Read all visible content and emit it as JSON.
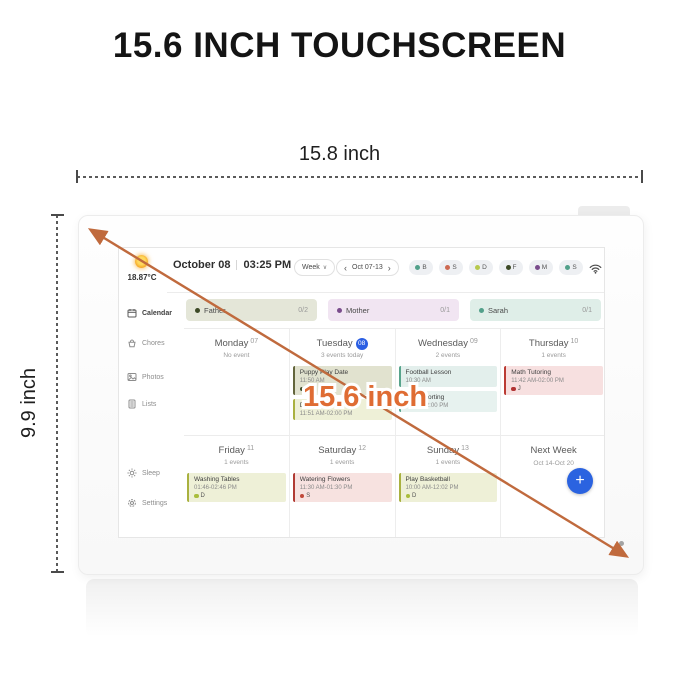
{
  "annotation": {
    "title": "15.6 INCH TOUCHSCREEN",
    "width_label": "15.8 inch",
    "height_label": "9.9 inch",
    "diagonal_label": "15.6 inch",
    "arrow_color": "#c06a3d",
    "diagonal_label_color": "#df6c33"
  },
  "screen": {
    "weather": {
      "temperature": "18.87°C"
    },
    "header": {
      "date": "October 08",
      "time": "03:25 PM",
      "view": "Week",
      "range": "Oct 07-13",
      "avatars": [
        {
          "initial": "B",
          "color": "#52a08a"
        },
        {
          "initial": "S",
          "color": "#cd6a52"
        },
        {
          "initial": "D",
          "color": "#b7c94e"
        },
        {
          "initial": "F",
          "color": "#3d4a26"
        },
        {
          "initial": "M",
          "color": "#7a4c8c"
        },
        {
          "initial": "S",
          "color": "#52a08a"
        }
      ]
    },
    "sidebar": [
      {
        "label": "Calendar",
        "icon": "calendar-icon"
      },
      {
        "label": "Chores",
        "icon": "chores-icon"
      },
      {
        "label": "Photos",
        "icon": "photos-icon"
      },
      {
        "label": "Lists",
        "icon": "lists-icon"
      },
      {
        "label": "Sleep",
        "icon": "sleep-icon"
      },
      {
        "label": "Settings",
        "icon": "settings-icon"
      }
    ],
    "members": [
      {
        "name": "Father",
        "count": "0/2",
        "dot": "#3d4a26",
        "bg": "#e4e6d8"
      },
      {
        "name": "Mother",
        "count": "0/1",
        "dot": "#7a4c8c",
        "bg": "#f1e5f2"
      },
      {
        "name": "Sarah",
        "count": "0/1",
        "dot": "#52a08a",
        "bg": "#dfeee8"
      }
    ],
    "week": {
      "today_badge_color": "#2b5fe3",
      "add_button_color": "#2b63e0",
      "days": [
        {
          "name": "Monday",
          "num": "07",
          "sub": "No event",
          "events": []
        },
        {
          "name": "Tuesday",
          "num": "08",
          "sub": "3 events today",
          "events": [
            {
              "title": "Puppy Play Date",
              "time": "11:50 AM",
              "who": "F",
              "who_color": "#3d4a26",
              "bg": "#e1e2cf",
              "border": "#63653c"
            },
            {
              "title": "Drying Laundry",
              "time": "11:51 AM-02:00 PM",
              "bg": "#eef0d7",
              "border": "#a9b13f"
            }
          ]
        },
        {
          "name": "Wednesday",
          "num": "09",
          "sub": "2 events",
          "events": [
            {
              "title": "Football Lesson",
              "time": "10:30 AM",
              "bg": "#e3efec",
              "border": "#58a48c"
            },
            {
              "title": "Trash Sorting",
              "time": "01:00-02:00 PM",
              "bg": "#e7f2ef",
              "border": "#58a48c"
            }
          ]
        },
        {
          "name": "Thursday",
          "num": "10",
          "sub": "1 events",
          "events": [
            {
              "title": "Math Tutoring",
              "time": "11:42 AM-02:00 PM",
              "who": "J",
              "who_color": "#b13434",
              "bg": "#f7e0e0",
              "border": "#bb3b34"
            }
          ]
        },
        {
          "name": "Friday",
          "num": "11",
          "sub": "1 events",
          "events": [
            {
              "title": "Washing Tables",
              "time": "01:46-02:46 PM",
              "who": "D",
              "who_color": "#a9bd3c",
              "bg": "#eef0d7",
              "border": "#a9b13f"
            }
          ]
        },
        {
          "name": "Saturday",
          "num": "12",
          "sub": "1 events",
          "events": [
            {
              "title": "Watering Flowers",
              "time": "11:30 AM-01:30 PM",
              "who": "S",
              "who_color": "#c0493a",
              "bg": "#f7e2e0",
              "border": "#b13a33"
            }
          ]
        },
        {
          "name": "Sunday",
          "num": "13",
          "sub": "1 events",
          "events": [
            {
              "title": "Play Basketball",
              "time": "10:00 AM-12:02 PM",
              "who": "D",
              "who_color": "#a9bd3c",
              "bg": "#eef0d7",
              "border": "#a9b13f"
            }
          ]
        }
      ],
      "next_week": {
        "label": "Next Week",
        "range": "Oct 14-Oct 20"
      }
    }
  }
}
